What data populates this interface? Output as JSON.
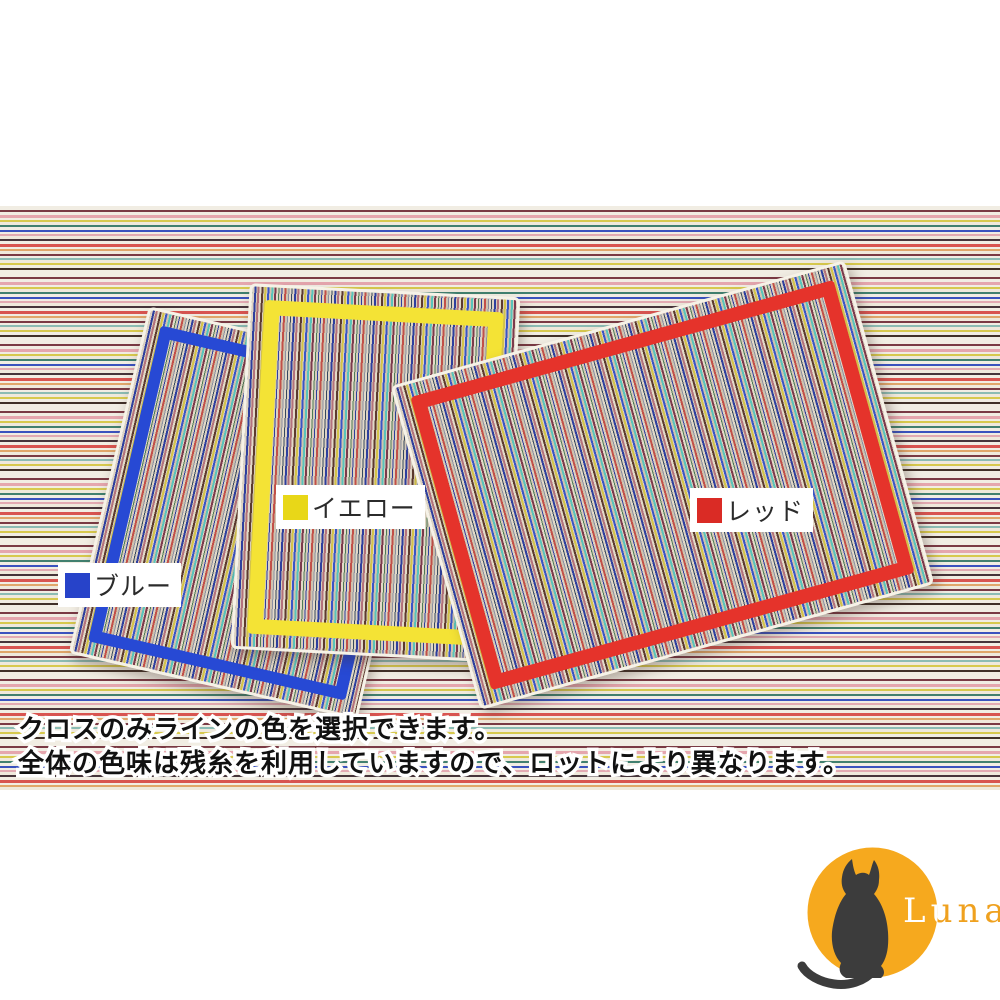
{
  "image": {
    "labels": [
      {
        "text": "ブルー",
        "swatch_color": "#2743c9",
        "line_color": "#2749d4"
      },
      {
        "text": "イエロー",
        "swatch_color": "#e8d718",
        "line_color": "#f4e335"
      },
      {
        "text": "レッド",
        "swatch_color": "#da2b25",
        "line_color": "#e5332b"
      }
    ],
    "caption": {
      "line1": "クロスのみラインの色を選択できます。",
      "line2": "全体の色味は残糸を利用していますので、ロットにより異なります。"
    }
  },
  "logo": {
    "brand": "Luna",
    "moon_color": "#f6a91e",
    "brand_color": "#efa11f",
    "cat_color": "#3c3c3c"
  }
}
